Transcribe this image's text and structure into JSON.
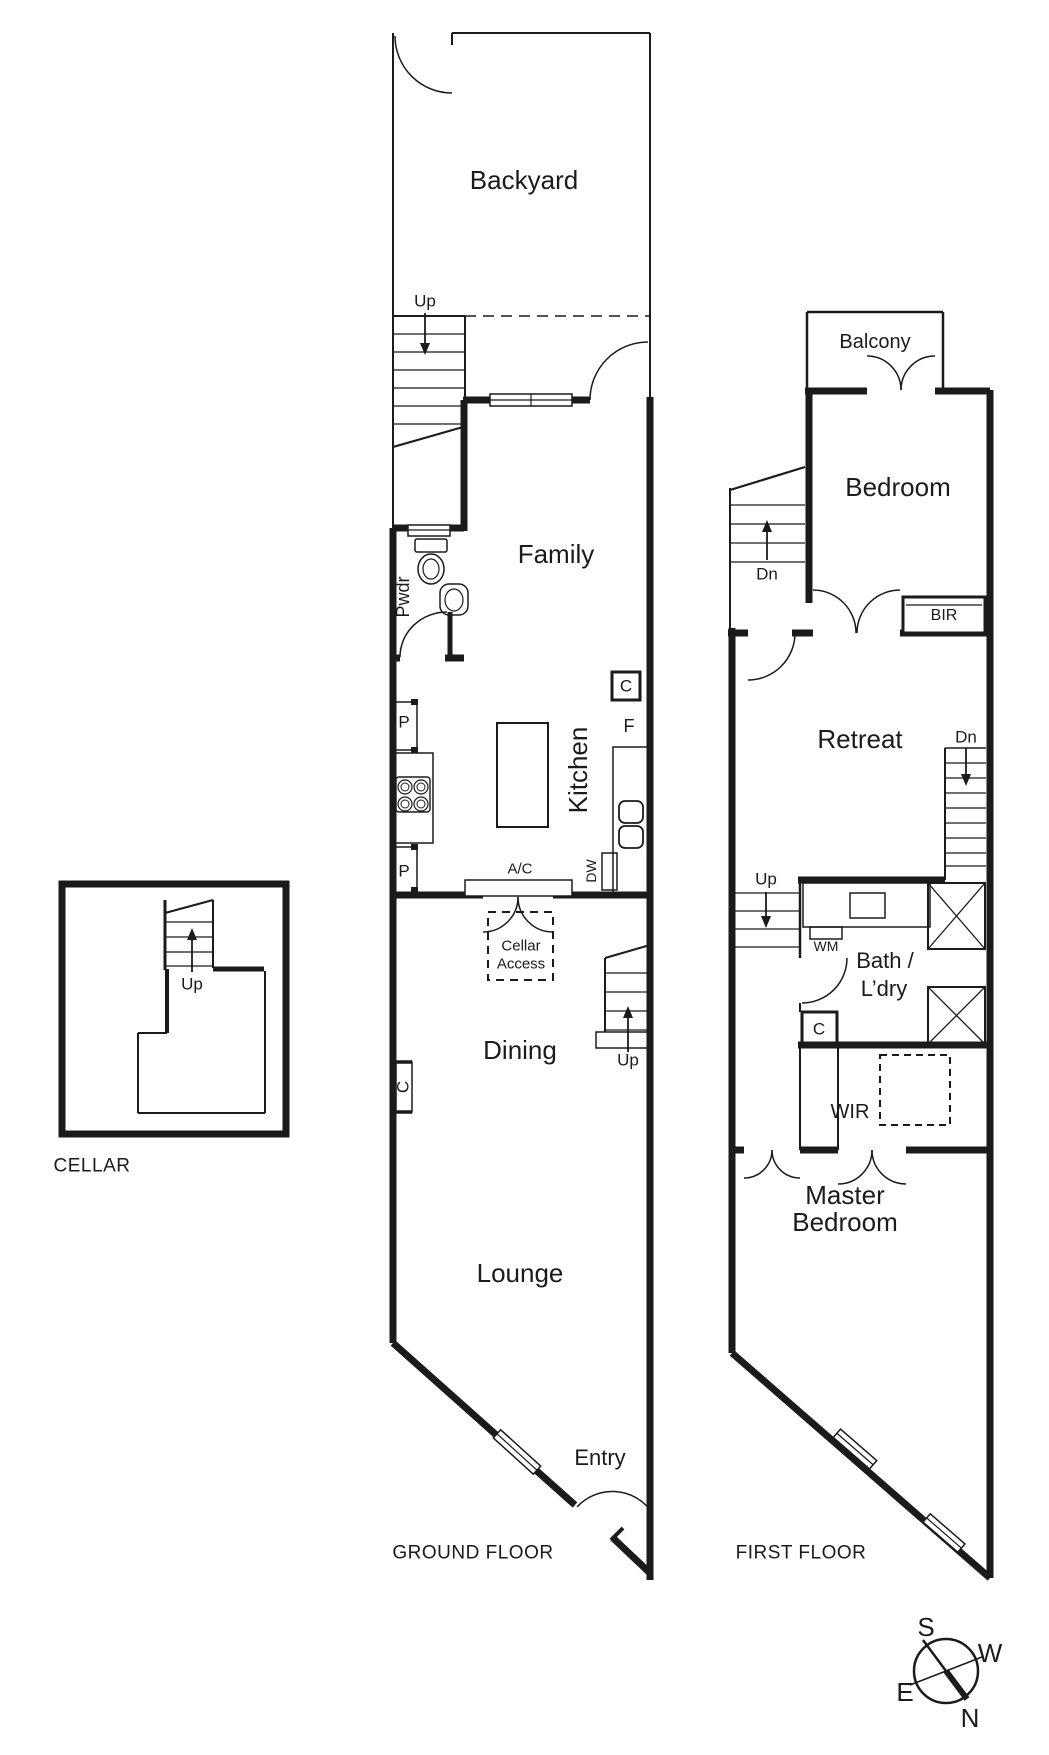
{
  "ground_floor": {
    "title": "GROUND FLOOR",
    "rooms": {
      "backyard": "Backyard",
      "family": "Family",
      "kitchen": "Kitchen",
      "pwdr": "Pwdr",
      "dining": "Dining",
      "lounge": "Lounge",
      "entry": "Entry"
    },
    "labels": {
      "stair_up_backyard": "Up",
      "stair_up_dining": "Up",
      "pantry_upper": "P",
      "pantry_lower": "P",
      "cupboard_kitchen": "C",
      "cupboard_wall": "C",
      "fridge": "F",
      "dishwasher": "DW",
      "aircon": "A/C",
      "cellar_access_1": "Cellar",
      "cellar_access_2": "Access"
    }
  },
  "cellar": {
    "title": "CELLAR",
    "labels": {
      "stair_up": "Up"
    }
  },
  "first_floor": {
    "title": "FIRST FLOOR",
    "rooms": {
      "balcony": "Balcony",
      "bedroom": "Bedroom",
      "retreat": "Retreat",
      "bath_1": "Bath /",
      "bath_2": "L’dry",
      "wir": "WIR",
      "master_1": "Master",
      "master_2": "Bedroom"
    },
    "labels": {
      "stair_dn_bedroom": "Dn",
      "stair_dn_retreat": "Dn",
      "stair_up_attic": "Up",
      "washing_machine": "WM",
      "built_in_robe": "BIR",
      "cupboard": "C"
    }
  },
  "compass": {
    "s": "S",
    "w": "W",
    "e": "E",
    "n": "N"
  },
  "colors": {
    "line": "#1b1b1b",
    "background": "#ffffff"
  }
}
